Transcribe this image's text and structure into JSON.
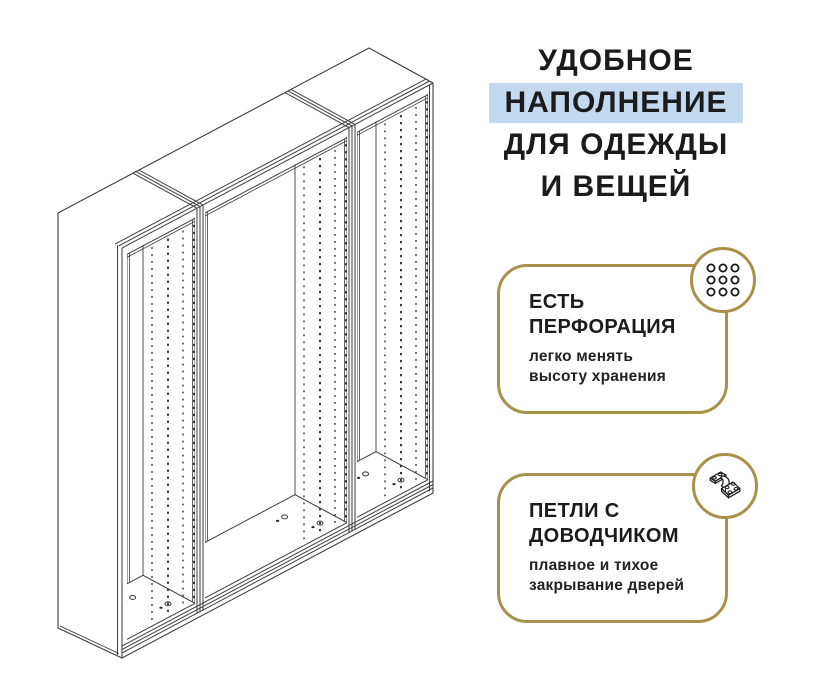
{
  "colors": {
    "accent_gold": "#a8924a",
    "highlight_blue": "#c3d9f0",
    "text_dark": "#1b1b1b",
    "line_gray": "#3e3e3e",
    "page_bg": "#ffffff"
  },
  "heading": {
    "line1": "УДОБНОЕ",
    "line2_highlighted": "НАПОЛНЕНИЕ",
    "line3": "ДЛЯ ОДЕЖДЫ",
    "line4": "И ВЕЩЕЙ"
  },
  "features": [
    {
      "title_line1": "ЕСТЬ",
      "title_line2": "ПЕРФОРАЦИЯ",
      "subtitle_line1": "легко менять",
      "subtitle_line2": "высоту хранения",
      "icon": "perforation-holes-icon"
    },
    {
      "title_line1": "ПЕТЛИ С",
      "title_line2": "ДОВОДЧИКОМ",
      "subtitle_line1": "плавное и тихое",
      "subtitle_line2": "закрывание дверей",
      "icon": "soft-close-hinge-icon"
    }
  ],
  "illustration": {
    "subject": "wardrobe-frame-line-drawing",
    "sections": 3
  }
}
